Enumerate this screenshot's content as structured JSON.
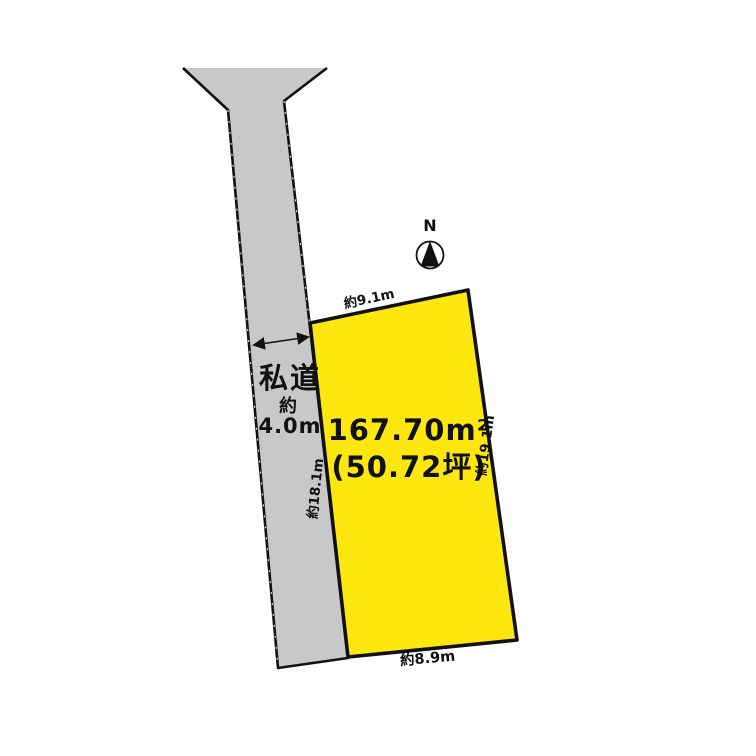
{
  "diagram": {
    "compass": {
      "label": "N"
    },
    "road": {
      "name": "私道",
      "width_prefix": "約",
      "width_value": "4.0m"
    },
    "plot": {
      "area_sqm": "167.70m²",
      "area_tsubo": "(50.72坪)",
      "edge_top": "約9.1m",
      "edge_right": "約19.1m",
      "edge_left": "約18.1m",
      "edge_bottom": "約8.9m"
    },
    "colors": {
      "background": "#ffffff",
      "road_fill": "#c8c8c8",
      "plot_fill": "#fde70f",
      "line": "#111111"
    }
  }
}
